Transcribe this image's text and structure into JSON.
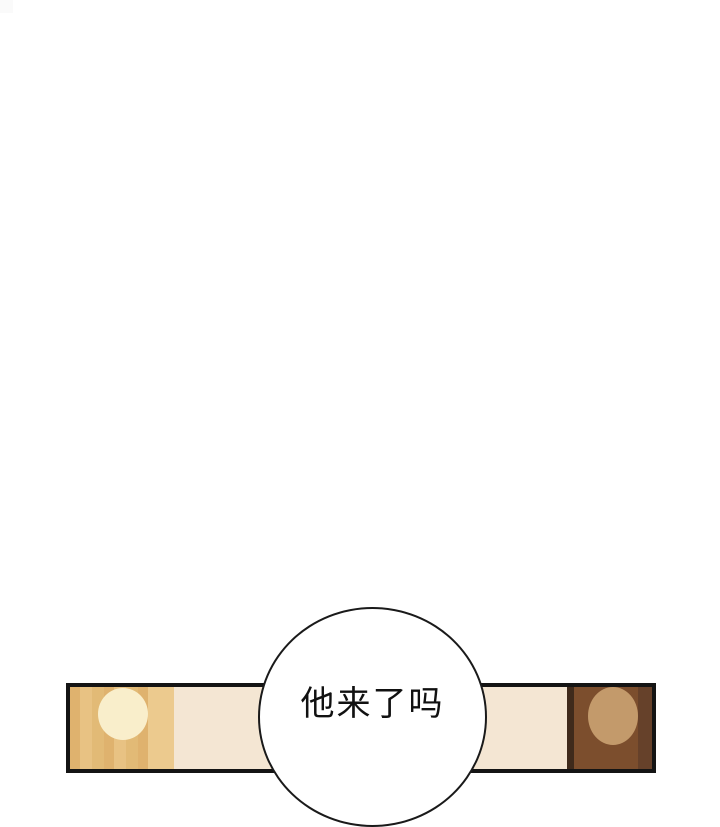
{
  "page": {
    "background": "#ffffff",
    "corner_artifact_color": "#fafafa"
  },
  "speech_bubble": {
    "text": "他来了吗",
    "fill": "#ffffff",
    "outline_color": "#1a1a1a",
    "text_color": "#111111"
  },
  "panel": {
    "border_color": "#141414",
    "scene_colors": {
      "left_wall_tan": "#e2ba76",
      "lamp_cream": "#f9eecb",
      "gold_band": "#ecca8e",
      "beige_wall": "#f4e6d3",
      "dark_divider": "#3f2a1b",
      "brown_wall": "#7c4e2d",
      "head_tan": "#c39a6b",
      "dark_edge": "#66412a"
    }
  }
}
